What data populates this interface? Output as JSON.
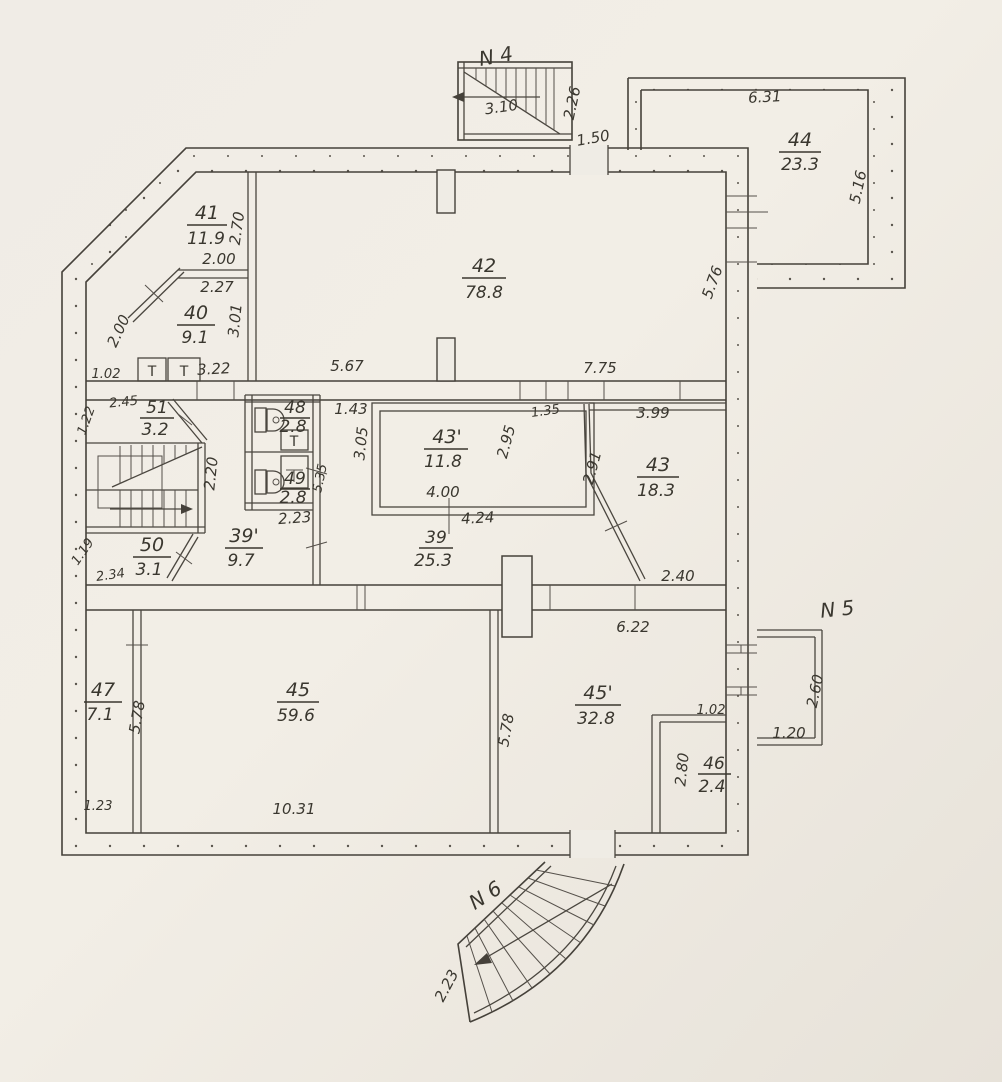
{
  "drawing": {
    "type": "floor-plan",
    "ink_color": "#45413a",
    "paper_color": "#efece5"
  },
  "stairs": {
    "n4": "N 4",
    "n5": "N 5",
    "n6": "N 6"
  },
  "rooms": {
    "r41": {
      "num": "41",
      "area": "11.9"
    },
    "r40": {
      "num": "40",
      "area": "9.1"
    },
    "r42": {
      "num": "42",
      "area": "78.8"
    },
    "r44": {
      "num": "44",
      "area": "23.3"
    },
    "r51": {
      "num": "51",
      "area": "3.2"
    },
    "r50": {
      "num": "50",
      "area": "3.1"
    },
    "r48": {
      "num": "48",
      "area": "2.8"
    },
    "r49": {
      "num": "49",
      "area": "2.8"
    },
    "r39p": {
      "num": "39'",
      "area": "9.7"
    },
    "r39": {
      "num": "39",
      "area": "25.3"
    },
    "r43p": {
      "num": "43'",
      "area": "11.8"
    },
    "r43": {
      "num": "43",
      "area": "18.3"
    },
    "r47": {
      "num": "47",
      "area": "7.1"
    },
    "r45": {
      "num": "45",
      "area": "59.6"
    },
    "r45p": {
      "num": "45'",
      "area": "32.8"
    },
    "r46": {
      "num": "46",
      "area": "2.4"
    }
  },
  "dims": {
    "stair4_run": "3.10",
    "stair4_depth": "2.26",
    "top_door": "1.50",
    "annex_top": "6.31",
    "annex_right": "5.16",
    "right_wall_upper": "5.76",
    "r41_height": "2.70",
    "r41_bottom": "2.00",
    "r40_top": "2.27",
    "r40_height": "3.01",
    "r40_diag": "2.00",
    "left_strip": "1.02",
    "wc_top": "3.22",
    "corr1_mid": "5.67",
    "corr1_right": "7.75",
    "left_51": "2.45",
    "left_wall_51": "1.22",
    "stair_width": "2.20",
    "left_wall_50": "1.19",
    "left_50": "2.34",
    "gap_143": "1.43",
    "r43p_left": "3.05",
    "r43p_right": "2.95",
    "gap_135": "1.35",
    "r43p_width": "4.00",
    "r39_width": "4.24",
    "wc_bottom": "2.23",
    "wc_right": "5.35",
    "r43_diag": "2.91",
    "r43_top": "3.99",
    "corr2_right": "2.40",
    "corr2_below": "6.22",
    "r47_wall": "5.78",
    "r45_wall": "5.78",
    "r47_bottom": "1.23",
    "r45_bottom": "10.31",
    "r46_top": "1.02",
    "r46_left": "2.80",
    "porch_height": "2.60",
    "porch_bottom": "1.20",
    "stair6_side": "2.23"
  },
  "fixtures": {
    "tank": "T"
  }
}
